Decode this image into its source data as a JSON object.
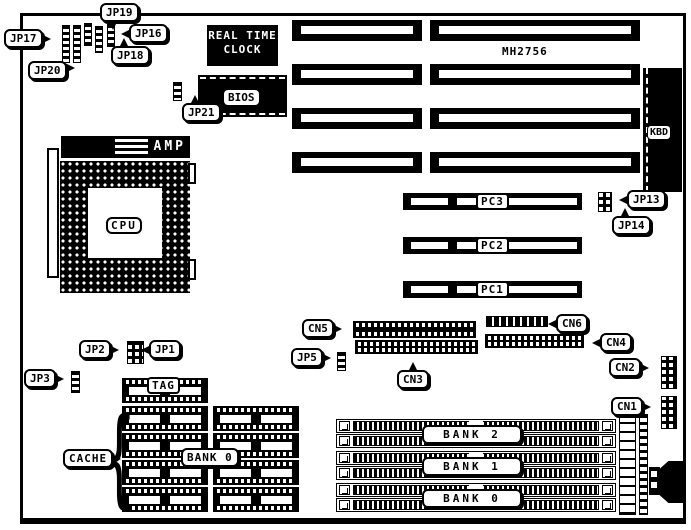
{
  "board": {
    "model": "MH2756",
    "rtc": {
      "line1": "REAL TIME",
      "line2": "CLOCK"
    },
    "parts": {
      "bios": "BIOS",
      "kbd": "KBD",
      "amp": "AMP",
      "cpu": "CPU",
      "tag": "TAG",
      "cache_label": "CACHE",
      "cache_bank_label": "BANK 0",
      "brace_glyph": "{"
    },
    "jumpers": {
      "jp1": "JP1",
      "jp2": "JP2",
      "jp3": "JP3",
      "jp5": "JP5",
      "jp13": "JP13",
      "jp14": "JP14",
      "jp16": "JP16",
      "jp17": "JP17",
      "jp18": "JP18",
      "jp19": "JP19",
      "jp20": "JP20",
      "jp21": "JP21"
    },
    "connectors": {
      "cn1": "CN1",
      "cn2": "CN2",
      "cn3": "CN3",
      "cn4": "CN4",
      "cn5": "CN5",
      "cn6": "CN6"
    },
    "pci_slots": [
      "PC3",
      "PC2",
      "PC1"
    ],
    "simm_banks": [
      "BANK 2",
      "BANK 1",
      "BANK 0"
    ],
    "colors": {
      "ink": "#000000",
      "paper": "#ffffff"
    }
  }
}
